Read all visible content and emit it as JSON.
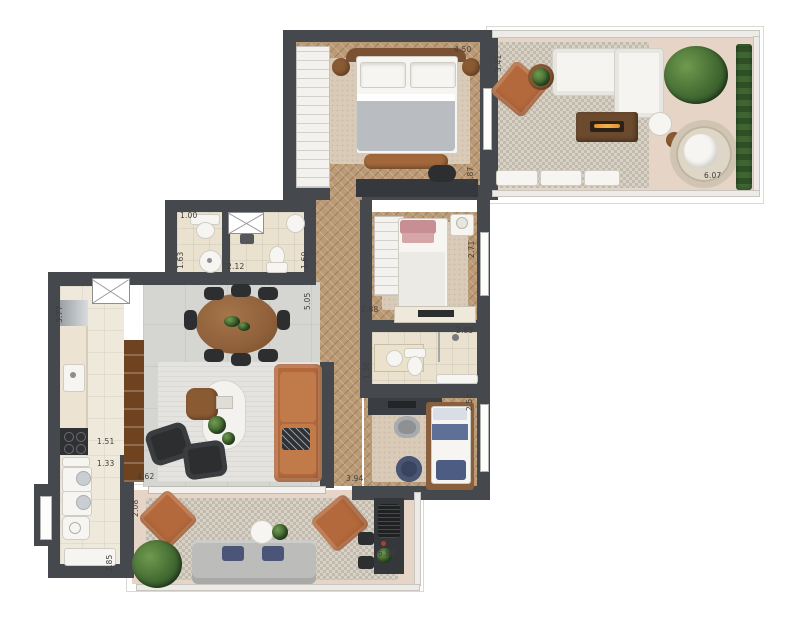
{
  "plan": {
    "type": "residential-floor-plan-top-view",
    "colors": {
      "background": "#ffffff",
      "wall": "#45484d",
      "wood_floor": "#bb9a76",
      "living_tile": "#d5d5d2",
      "bath_tile": "#eae2cf",
      "terrace_floor": "#e6d4c6",
      "leather_accent": "#b4693c",
      "plant_green": "#3f6630",
      "dark_furniture": "#2c2e30"
    },
    "dimensions": {
      "master_width": "4.50",
      "master_depth": "3.87",
      "terrace_upper_depth": "3.41",
      "terrace_upper_width": "6.07",
      "wc_width": "1.00",
      "wc_depth": "1.63",
      "bath_social_width": "2.12",
      "bath_social_depth": "1.60",
      "hall_length": "5.05",
      "bedroom2_depth": "2.71",
      "bedroom2_width": "2.88",
      "bath_suite_width": "2.85",
      "bath_suite_depth": "1.30",
      "bedroom3_depth": "2.50",
      "bedroom3_width": "3.94",
      "kitchen_depth": "3.77",
      "kitchen_seg1": "1.51",
      "kitchen_seg2": "1.33",
      "living_width": "4.62",
      "service_depth": "2.85",
      "terrace_lower_depth": "2.08",
      "terrace_lower_width": "6.84"
    }
  }
}
